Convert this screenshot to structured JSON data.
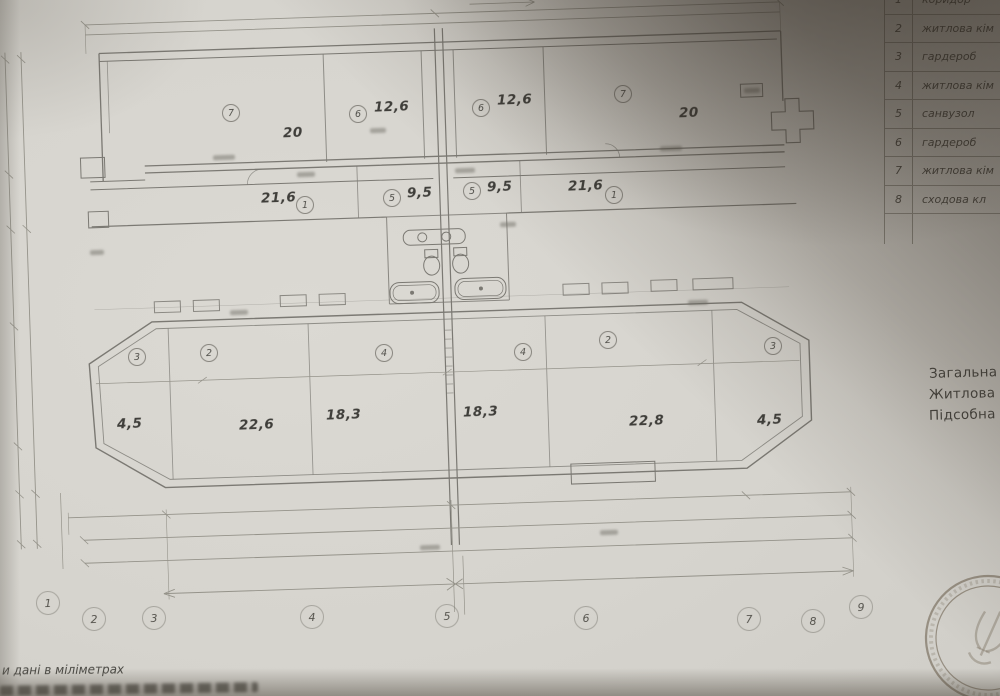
{
  "drawing": {
    "rooms": [
      {
        "id": "7",
        "area": "20"
      },
      {
        "id": "6",
        "area": "12,6"
      },
      {
        "id": "6",
        "area": "12,6"
      },
      {
        "id": "7",
        "area": "20"
      },
      {
        "id": "1",
        "area": "21,6"
      },
      {
        "id": "5",
        "area": "9,5"
      },
      {
        "id": "5",
        "area": "9,5"
      },
      {
        "id": "1",
        "area": "21,6"
      },
      {
        "id": "3",
        "area": "4,5"
      },
      {
        "id": "2",
        "area": "22,6"
      },
      {
        "id": "4",
        "area": "18,3"
      },
      {
        "id": "4",
        "area": "18,3"
      },
      {
        "id": "2",
        "area": "22,8"
      },
      {
        "id": "3",
        "area": "4,5"
      }
    ],
    "axes": [
      "1",
      "2",
      "3",
      "4",
      "5",
      "6",
      "7",
      "8",
      "9"
    ]
  },
  "table": {
    "rows": [
      {
        "num": "1",
        "name": "коридор"
      },
      {
        "num": "2",
        "name": "житлова кім"
      },
      {
        "num": "3",
        "name": "гардероб"
      },
      {
        "num": "4",
        "name": "житлова кім"
      },
      {
        "num": "5",
        "name": "санвузол"
      },
      {
        "num": "6",
        "name": "гардероб"
      },
      {
        "num": "7",
        "name": "житлова кім"
      },
      {
        "num": "8",
        "name": "сходова кл"
      }
    ]
  },
  "summary": {
    "lines": [
      "Загальна",
      "Житлова",
      "Підсобна"
    ]
  },
  "notes": {
    "line1": "и дані в міліметрах"
  },
  "colors": {
    "paper": "#d6d4ce",
    "ink": "#716f69",
    "dim": "#8e8c83",
    "shadow": "#322a21"
  }
}
